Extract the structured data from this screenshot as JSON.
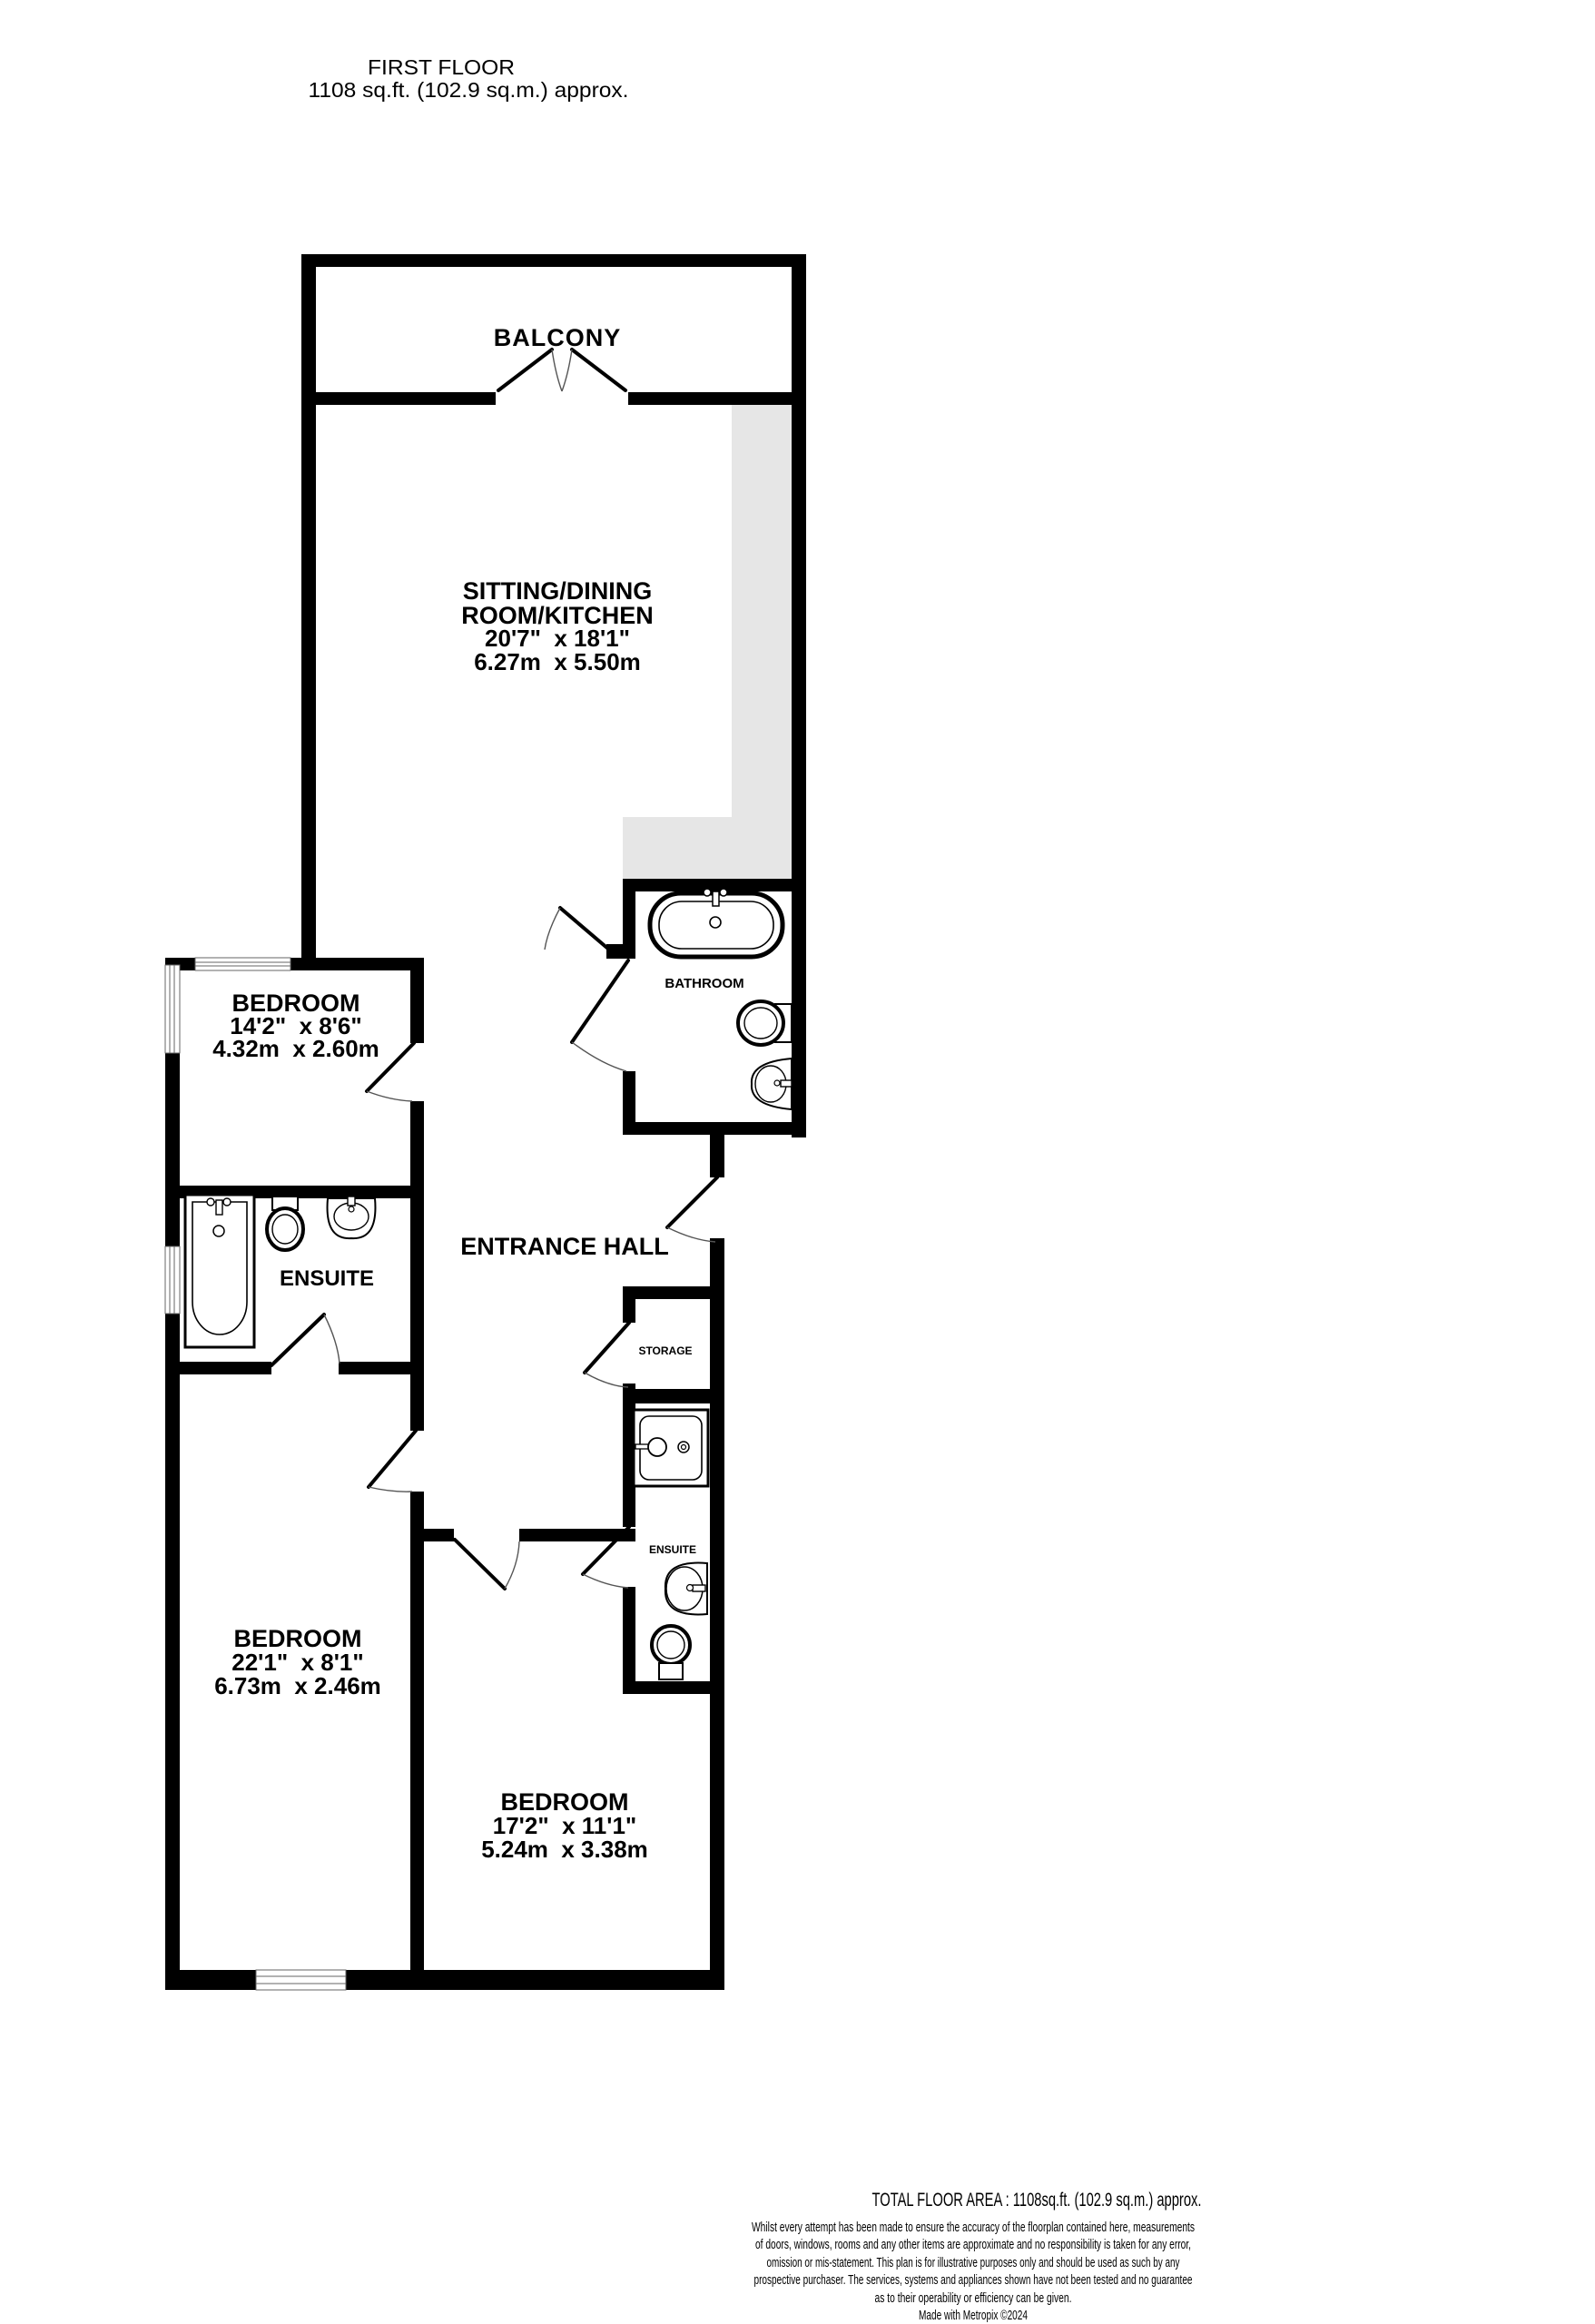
{
  "header": {
    "line1": "FIRST FLOOR",
    "line2": "1108 sq.ft. (102.9 sq.m.) approx."
  },
  "rooms": {
    "balcony": {
      "name": "BALCONY"
    },
    "sitting": {
      "name_line1": "SITTING/DINING",
      "name_line2": "ROOM/KITCHEN",
      "dims_imperial": "20'7\"  x 18'1\"",
      "dims_metric": "6.27m  x 5.50m"
    },
    "bedroom1": {
      "name": "BEDROOM",
      "dims_imperial": "14'2\"  x 8'6\"",
      "dims_metric": "4.32m  x 2.60m"
    },
    "bathroom": {
      "name": "BATHROOM"
    },
    "entrance_hall": {
      "name": "ENTRANCE HALL"
    },
    "ensuite1": {
      "name": "ENSUITE"
    },
    "storage": {
      "name": "STORAGE"
    },
    "ensuite2": {
      "name": "ENSUITE"
    },
    "bedroom2": {
      "name": "BEDROOM",
      "dims_imperial": "22'1\"  x 8'1\"",
      "dims_metric": "6.73m  x 2.46m"
    },
    "bedroom3": {
      "name": "BEDROOM",
      "dims_imperial": "17'2\"  x 11'1\"",
      "dims_metric": "5.24m  x 3.38m"
    }
  },
  "footer": {
    "total_area": "TOTAL FLOOR AREA : 1108sq.ft. (102.9 sq.m.) approx.",
    "disclaimer_line1": "Whilst every attempt has been made to ensure the accuracy of the floorplan contained here, measurements",
    "disclaimer_line2": "of doors, windows, rooms and any other items are approximate and no responsibility is taken for any error,",
    "disclaimer_line3": "omission or mis-statement. This plan is for illustrative purposes only and should be used as such by any",
    "disclaimer_line4": "prospective purchaser. The services, systems and appliances shown have not been tested and no guarantee",
    "disclaimer_line5": "as to their operability or efficiency can be given.",
    "made_with": "Made with Metropix ©2024"
  },
  "colors": {
    "wall": "#000000",
    "counter_gray": "#e6e6e6",
    "background": "#ffffff"
  }
}
